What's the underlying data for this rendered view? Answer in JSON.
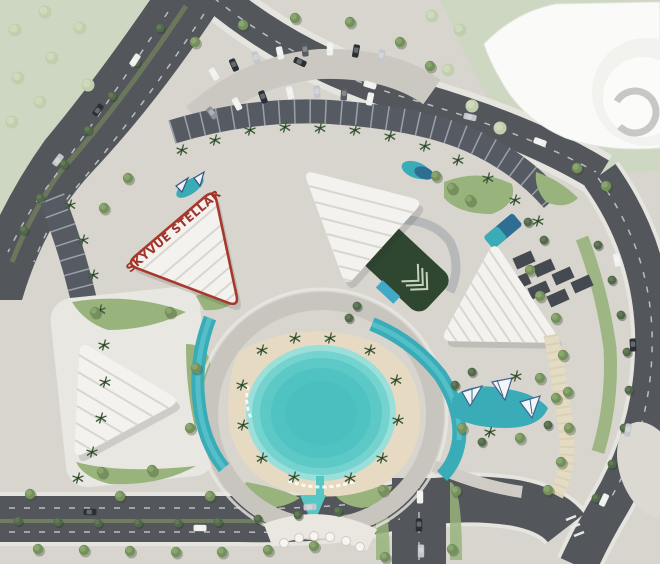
{
  "plan": {
    "highlight_label": "SKYVUE STELLAR"
  },
  "colors": {
    "highlight_outline": "#a9382c",
    "highlight_text": "#9e342a",
    "roof_white": "#f3f2ee",
    "roof_ridge": "#d9d6d0",
    "roof_dark": "#565b63",
    "paving": "#d8d5cf",
    "sand": "#e7dac2",
    "lagoon": "#57c7c5",
    "pool": "#3aacb8",
    "pool_deep": "#2e6e92",
    "road": "#53565b",
    "lane_mark": "#b9bec3",
    "park": "#cdd7c1",
    "grass": "#98b37b",
    "courtyard": "#2f4630",
    "canopy_tan": "#e4dbc4",
    "building_white": "#fafaf8"
  }
}
